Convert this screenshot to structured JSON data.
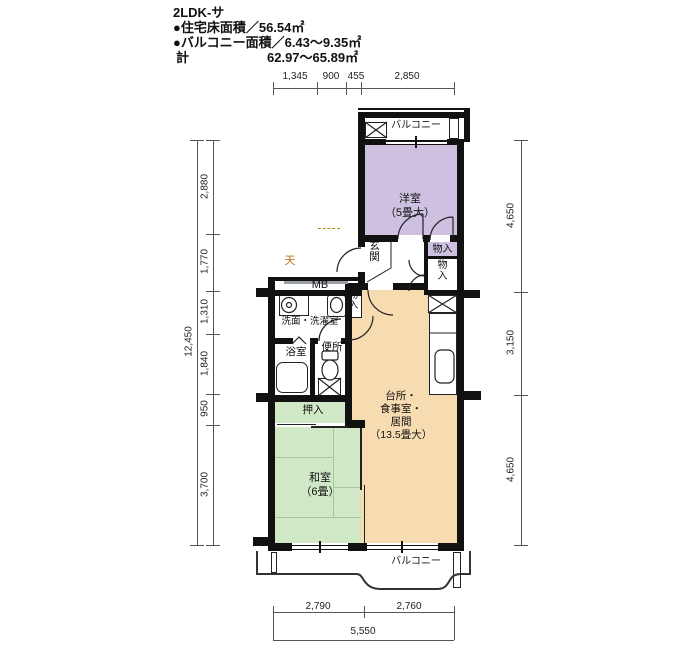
{
  "header": {
    "title": "2LDK-サ",
    "floor_area": "●住宅床面積／56.54㎡",
    "balcony_area": "●バルコニー面積／6.43～9.35㎡",
    "total_label": "計",
    "total_value": "62.97～65.89㎡"
  },
  "rooms": {
    "yoshitsu": {
      "label": "洋室",
      "size": "（5畳大）"
    },
    "ldk": {
      "l1": "台所・",
      "l2": "食事室・",
      "l3": "居間",
      "size": "（13.5畳大）"
    },
    "washitsu": {
      "label": "和室",
      "size": "（6畳）"
    },
    "genkan": "玄関",
    "oshiire": "押入",
    "monoire1": "物入",
    "monoire2": "物入",
    "monoire3": "物入",
    "mb": "MB",
    "senmen": "洗面・洗濯室",
    "yokushitsu": "浴室",
    "benjo": "便所",
    "ten": "天",
    "balcony_top": "バルコニー",
    "balcony_bottom": "バルコニー"
  },
  "dims": {
    "top": [
      "1,345",
      "900",
      "455",
      "2,850"
    ],
    "left_total": "12,450",
    "left": [
      "2,880",
      "1,770",
      "1,310",
      "1,840",
      "950",
      "3,700"
    ],
    "right": [
      "4,650",
      "3,150",
      "4,650"
    ],
    "bottom": [
      "2,790",
      "2,760"
    ],
    "bottom_total": "5,550"
  },
  "colors": {
    "western_room": "#cdc0e0",
    "ldk": "#f7dcb2",
    "tatami": "#d0e8c6",
    "wall": "#111111",
    "ten_text": "#c07818"
  }
}
